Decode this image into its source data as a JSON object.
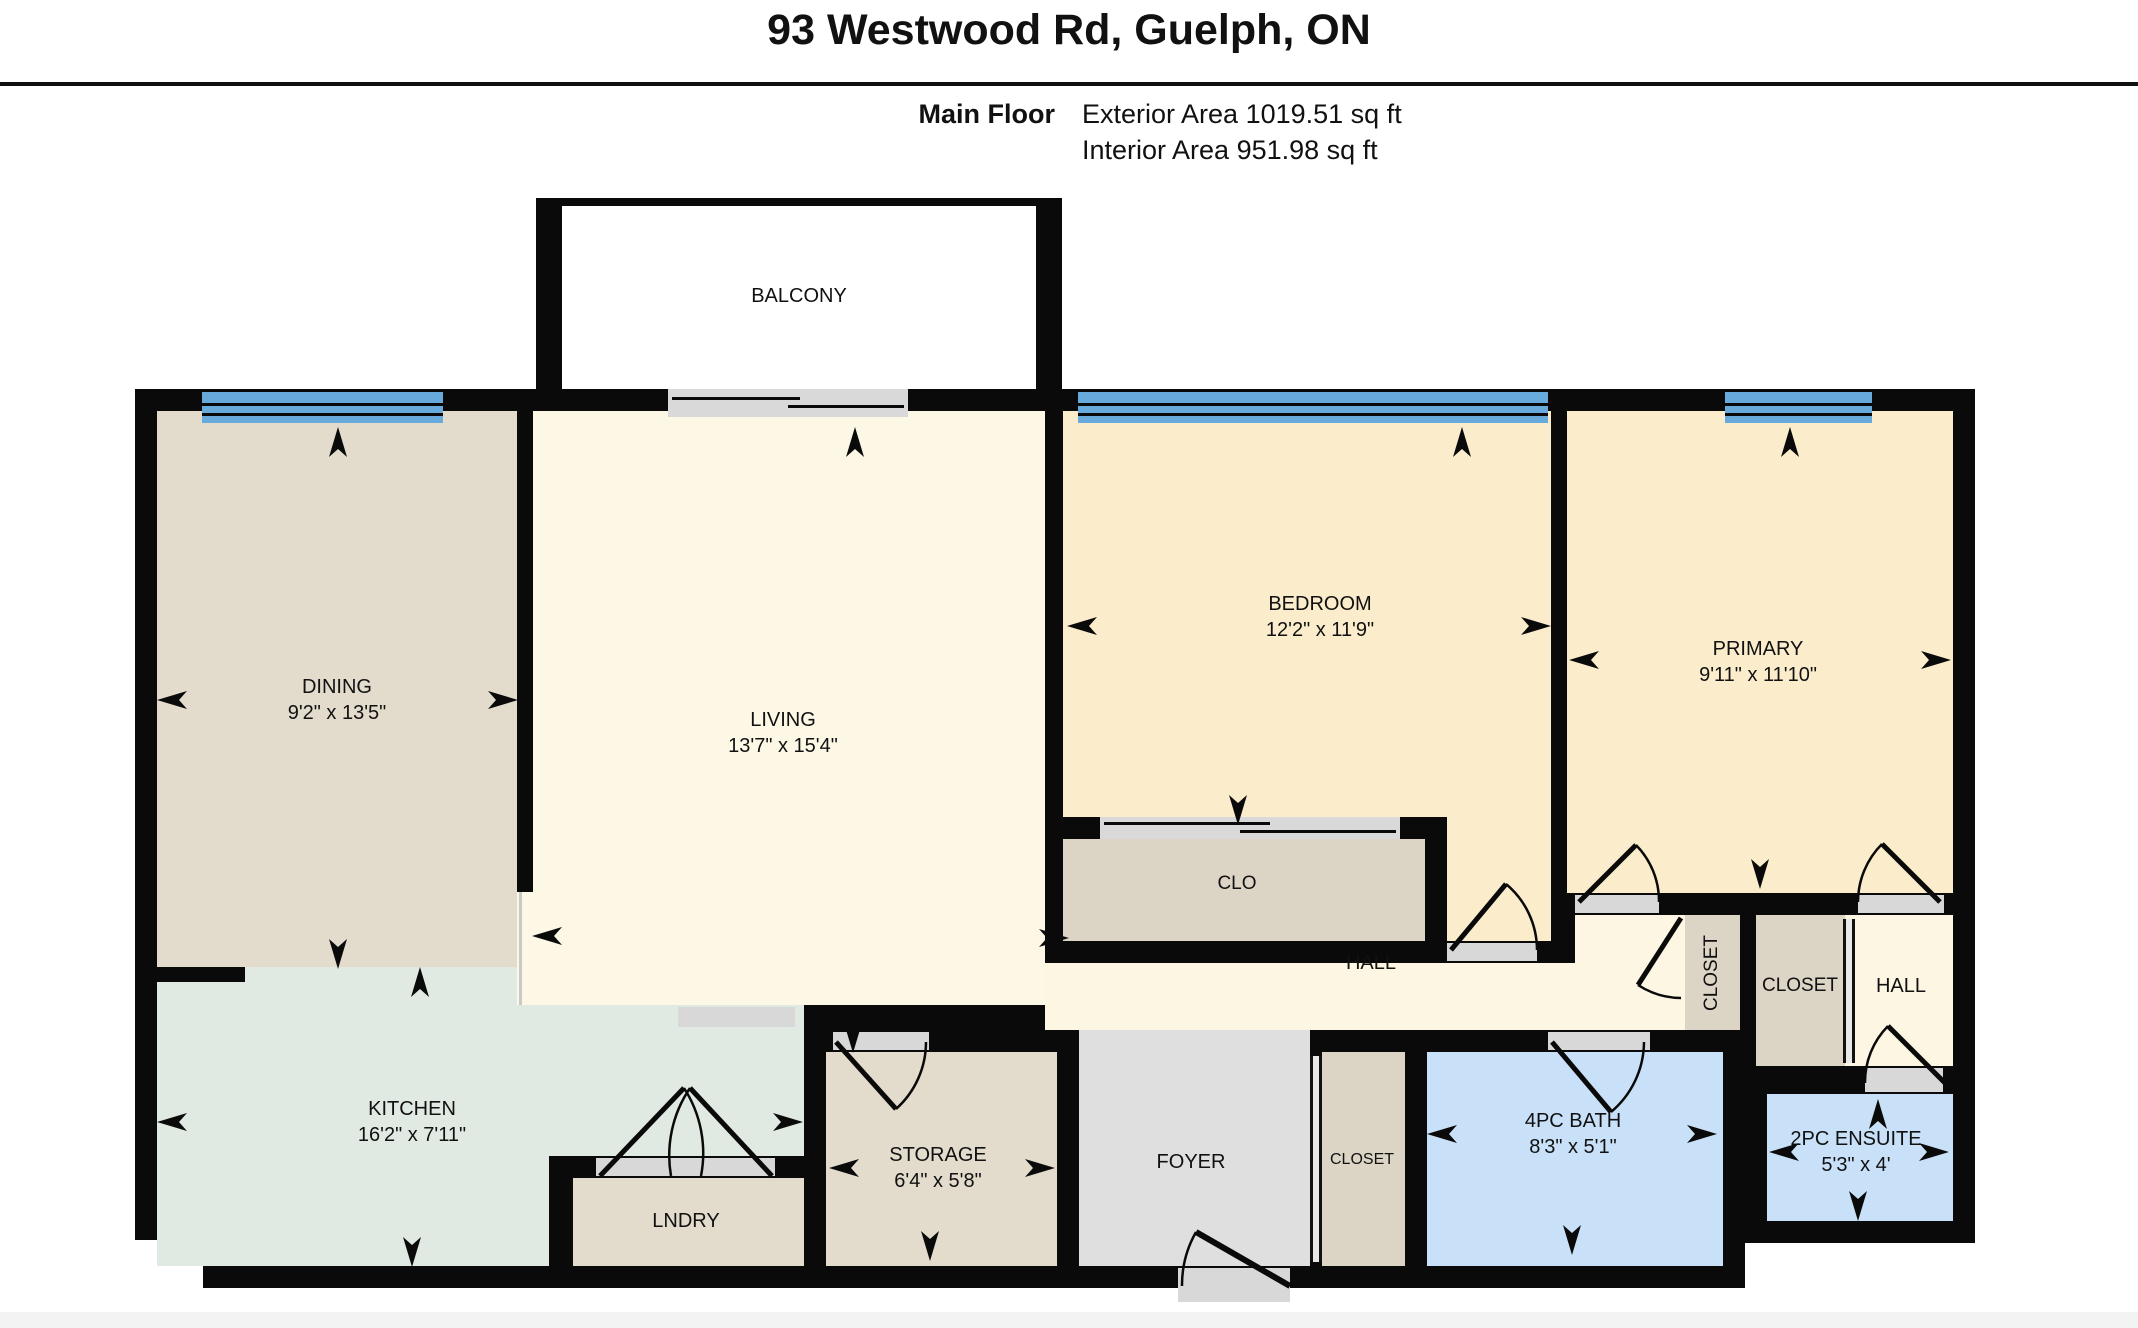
{
  "header": {
    "address": "93 Westwood Rd, Guelph, ON",
    "floor_label": "Main Floor",
    "exterior_area": "Exterior Area 1019.51 sq ft",
    "interior_area": "Interior Area 951.98 sq ft"
  },
  "rooms": {
    "balcony": {
      "name": "BALCONY"
    },
    "dining": {
      "name": "DINING",
      "dims": "9'2\" x 13'5\""
    },
    "living": {
      "name": "LIVING",
      "dims": "13'7\" x 15'4\""
    },
    "bedroom": {
      "name": "BEDROOM",
      "dims": "12'2\" x 11'9\""
    },
    "primary": {
      "name": "PRIMARY",
      "dims": "9'11\" x 11'10\""
    },
    "clo": {
      "name": "CLO"
    },
    "hall": {
      "name": "HALL"
    },
    "closet_hall": {
      "name": "CLOSET"
    },
    "closet_right": {
      "name": "CLOSET"
    },
    "hall_right": {
      "name": "HALL"
    },
    "kitchen": {
      "name": "KITCHEN",
      "dims": "16'2\" x 7'11\""
    },
    "lndry": {
      "name": "LNDRY"
    },
    "storage": {
      "name": "STORAGE",
      "dims": "6'4\" x 5'8\""
    },
    "foyer": {
      "name": "FOYER"
    },
    "closet_foyer": {
      "name": "CLOSET"
    },
    "bath": {
      "name": "4PC BATH",
      "dims": "8'3\" x 5'1\""
    },
    "ensuite": {
      "name": "2PC ENSUITE",
      "dims": "5'3\" x 4'"
    }
  },
  "colors": {
    "wall": "#0a0a0a",
    "window_glass": "#68aadc",
    "door_sill": "#d8d8d8",
    "dining_tan": "#e3dccd",
    "living_cream": "#fdf8e6",
    "bedroom_peach": "#fbeccb",
    "kitchen_mint": "#e1eae2",
    "closet_tan": "#dcd5c6",
    "foyer_gray": "#dfdfdf",
    "bath_blue": "#c9e1f8"
  }
}
